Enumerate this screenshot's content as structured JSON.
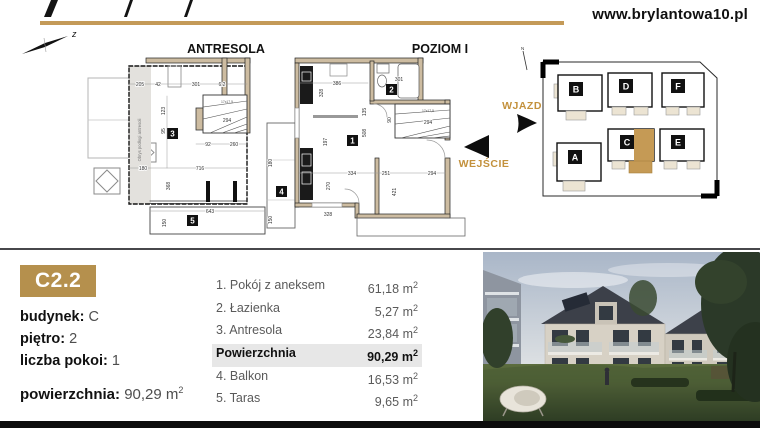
{
  "header": {
    "website": "www.brylantowa10.pl",
    "compass_label": "z"
  },
  "labels": {
    "entrance": "WEJŚCIE",
    "driveway": "WJAZD"
  },
  "plans": {
    "antresola": {
      "title": "ANTRESOLA",
      "mezzanine_note": "Obrys podłogi antresoli",
      "stair_note": "17x17,5",
      "markers": [
        "3",
        "5"
      ],
      "dims": [
        "205",
        "42",
        "301",
        "6.2",
        "123",
        "95",
        "294",
        "92",
        "260",
        "180",
        "716",
        "368",
        "643",
        "150"
      ]
    },
    "poziom1": {
      "title": "POZIOM I",
      "stair_note": "17x17,5",
      "markers": [
        "1",
        "2",
        "4"
      ],
      "dims": [
        "386",
        "301",
        "328",
        "135",
        "508",
        "90",
        "197",
        "294",
        "334",
        "251",
        "294",
        "270",
        "421",
        "328",
        "180",
        "150"
      ]
    }
  },
  "siteplan": {
    "compass_label": "N",
    "buildings": [
      {
        "label": "B"
      },
      {
        "label": "D"
      },
      {
        "label": "F"
      },
      {
        "label": "A"
      },
      {
        "label": "C",
        "highlighted": true
      },
      {
        "label": "E"
      }
    ]
  },
  "unit": {
    "code": "C2.2",
    "details": [
      {
        "label": "budynek:",
        "value": "C"
      },
      {
        "label": "piętro:",
        "value": "2"
      },
      {
        "label": "liczba pokoi:",
        "value": "1"
      },
      {
        "label": "powierzchnia:",
        "value": "90,29"
      }
    ],
    "units": {
      "base": "m",
      "sup": "2"
    },
    "rooms": [
      {
        "name": "1. Pokój z aneksem",
        "area": "61,18"
      },
      {
        "name": "2. Łazienka",
        "area": "5,27"
      },
      {
        "name": "3. Antresola",
        "area": "23,84"
      },
      {
        "name": "Powierzchnia",
        "area": "90,29"
      },
      {
        "name": "4. Balkon",
        "area": "16,53"
      },
      {
        "name": "5. Taras",
        "area": "9,65"
      }
    ]
  },
  "colors": {
    "gold": "#b5904d",
    "gold_rule": "#c49a58",
    "gold_text": "#c3913c",
    "wall_beige": "#cdbca1"
  }
}
